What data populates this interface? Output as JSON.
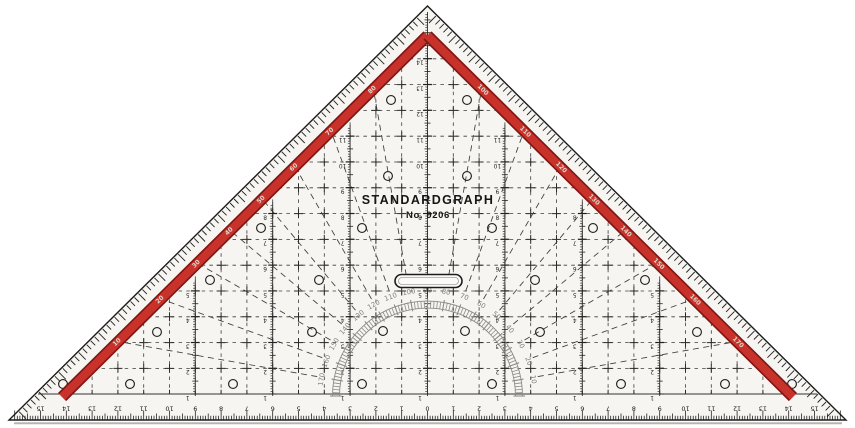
{
  "object": {
    "type": "drafting protractor set square (photo)",
    "brand": "STANDARDGRAPH",
    "model": "No. 9206"
  },
  "colors": {
    "background": "#ffffff",
    "body": "#f7f5f1",
    "ink": "#1c1c1c",
    "grid": "#3c3c3c",
    "stripe_red": "#c8322b",
    "stripe_red_dark": "#7e1714",
    "stripe_label": "#ddd5c9",
    "protractor_gray": "#8d8b87",
    "shadow": "#b9b5ae"
  },
  "protractor": {
    "degree_labels": [
      10,
      20,
      30,
      40,
      50,
      60,
      70,
      80,
      90,
      100,
      110,
      120,
      130,
      140,
      150,
      160,
      170
    ],
    "minor_tick_step_deg": 2,
    "major_tick_step_deg": 10
  },
  "edge_degree_scales": {
    "left_top_to_bottom": [
      80,
      70,
      60,
      50,
      40,
      30,
      20,
      10
    ],
    "right_top_to_bottom": [
      100,
      110,
      120,
      130,
      140,
      150,
      160,
      170
    ]
  },
  "bottom_ruler": {
    "unit": "cm",
    "zero_at_center": true,
    "labels": [
      15,
      14,
      13,
      12,
      11,
      10,
      9,
      8,
      7,
      6,
      5,
      4,
      3,
      2,
      1,
      0,
      1,
      2,
      3,
      4,
      5,
      6,
      7,
      8,
      9,
      10,
      11,
      12,
      13,
      14,
      15
    ]
  },
  "center_scale": {
    "unit": "cm",
    "min": 1,
    "max": 14
  },
  "vertical_scales": {
    "offsets_cm": [
      -9,
      -6,
      -3,
      0,
      3,
      6,
      9
    ],
    "numbering": "1 up from base"
  },
  "handle": {
    "present": true
  }
}
